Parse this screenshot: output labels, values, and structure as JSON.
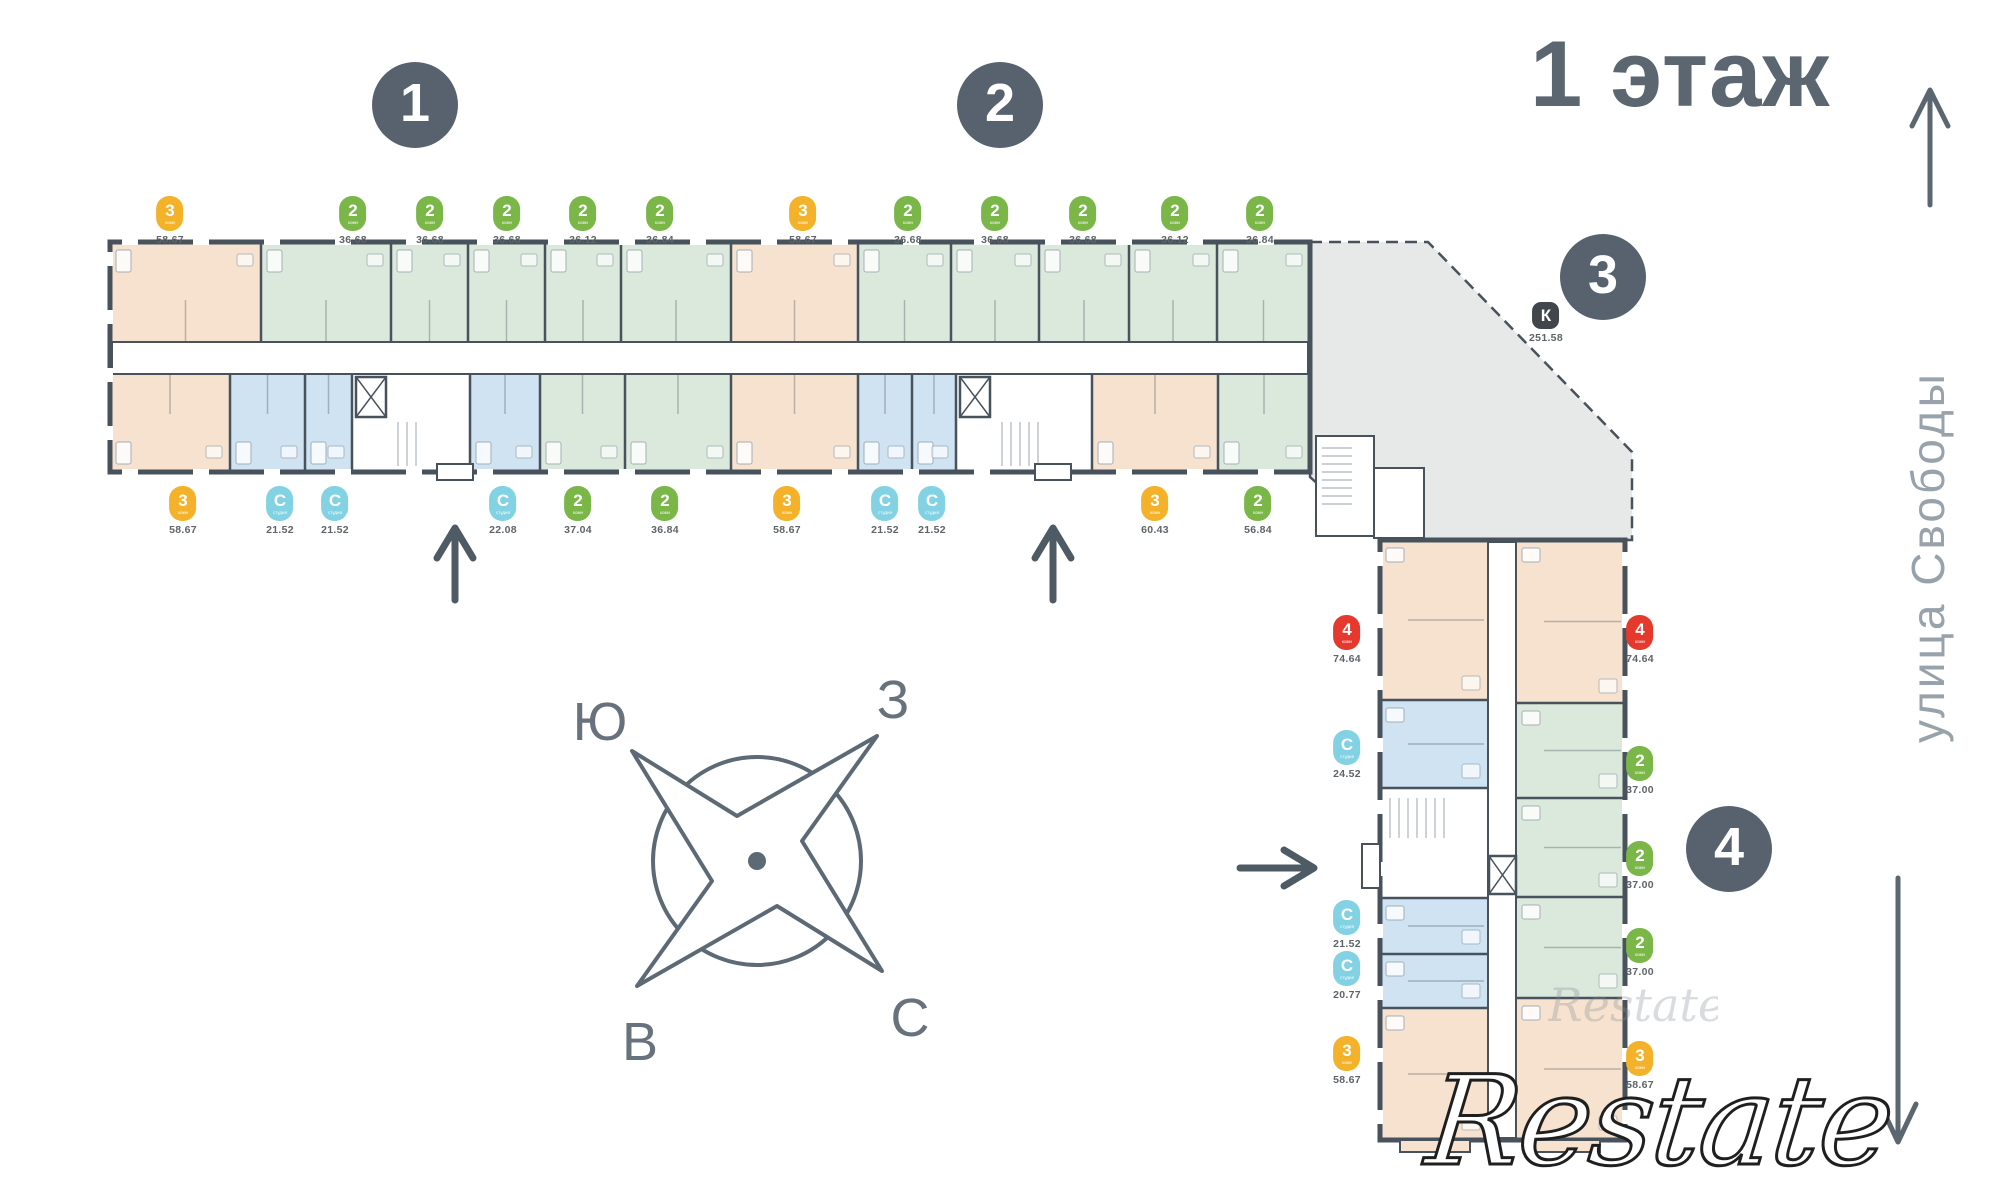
{
  "title": "1 этаж",
  "street_label": "улица Свободы",
  "watermark": "Restate",
  "watermark_faint": "Restate",
  "compass": {
    "south": "Ю",
    "west": "З",
    "east": "В",
    "north": "С"
  },
  "section_markers": [
    "1",
    "2",
    "3",
    "4"
  ],
  "legend_colors": {
    "rooms_2": "#7ab648",
    "rooms_3": "#f3b229",
    "rooms_4": "#e6392e",
    "studio": "#82d2e3",
    "commercial": "#40464b"
  },
  "plan_colors": {
    "walls": "#47525c",
    "tint_peach": "#f6e2cf",
    "tint_green": "#dbe9dc",
    "tint_blue": "#cfe3f2",
    "tint_gray": "#e7e9e9"
  },
  "commercial_badge": {
    "type": "К",
    "area": "251.58"
  },
  "badges": {
    "top_row": [
      {
        "type": "3",
        "sub": "комн",
        "area": "58.67"
      },
      {
        "type": "2",
        "sub": "комн",
        "area": "36.68"
      },
      {
        "type": "2",
        "sub": "комн",
        "area": "36.68"
      },
      {
        "type": "2",
        "sub": "комн",
        "area": "36.68"
      },
      {
        "type": "2",
        "sub": "комн",
        "area": "36.12"
      },
      {
        "type": "2",
        "sub": "комн",
        "area": "36.84"
      },
      {
        "type": "3",
        "sub": "комн",
        "area": "58.67"
      },
      {
        "type": "2",
        "sub": "комн",
        "area": "36.68"
      },
      {
        "type": "2",
        "sub": "комн",
        "area": "36.68"
      },
      {
        "type": "2",
        "sub": "комн",
        "area": "36.68"
      },
      {
        "type": "2",
        "sub": "комн",
        "area": "36.12"
      },
      {
        "type": "2",
        "sub": "комн",
        "area": "36.84"
      }
    ],
    "bottom_row": [
      {
        "type": "3",
        "sub": "комн",
        "area": "58.67"
      },
      {
        "type": "С",
        "sub": "студия",
        "area": "21.52"
      },
      {
        "type": "С",
        "sub": "студия",
        "area": "21.52"
      },
      {
        "type": "С",
        "sub": "студия",
        "area": "22.08"
      },
      {
        "type": "2",
        "sub": "комн",
        "area": "37.04"
      },
      {
        "type": "2",
        "sub": "комн",
        "area": "36.84"
      },
      {
        "type": "3",
        "sub": "комн",
        "area": "58.67"
      },
      {
        "type": "С",
        "sub": "студия",
        "area": "21.52"
      },
      {
        "type": "С",
        "sub": "студия",
        "area": "21.52"
      },
      {
        "type": "3",
        "sub": "комн",
        "area": "60.43"
      },
      {
        "type": "2",
        "sub": "комн",
        "area": "56.84"
      }
    ],
    "wing_left": [
      {
        "type": "4",
        "sub": "комн",
        "area": "74.64"
      },
      {
        "type": "С",
        "sub": "студия",
        "area": "24.52"
      },
      {
        "type": "С",
        "sub": "студия",
        "area": "21.52"
      },
      {
        "type": "С",
        "sub": "студия",
        "area": "20.77"
      },
      {
        "type": "3",
        "sub": "комн",
        "area": "58.67"
      }
    ],
    "wing_right": [
      {
        "type": "4",
        "sub": "комн",
        "area": "74.64"
      },
      {
        "type": "2",
        "sub": "комн",
        "area": "37.00"
      },
      {
        "type": "2",
        "sub": "комн",
        "area": "37.00"
      },
      {
        "type": "2",
        "sub": "комн",
        "area": "37.00"
      },
      {
        "type": "3",
        "sub": "комн",
        "area": "58.67"
      }
    ]
  }
}
